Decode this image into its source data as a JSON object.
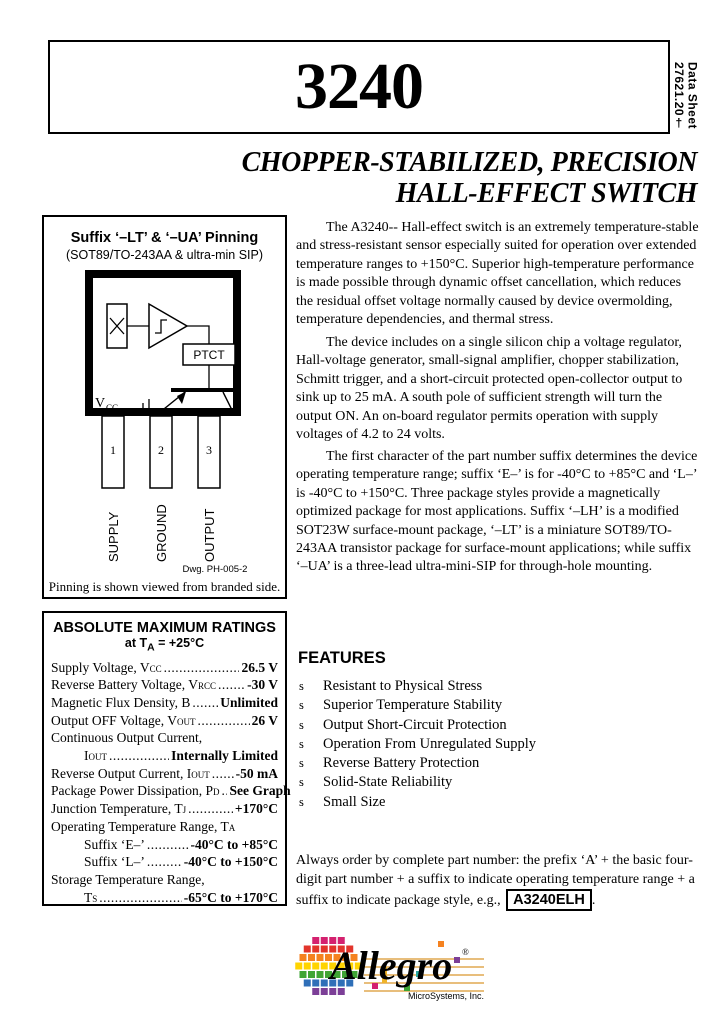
{
  "header": {
    "part_number": "3240",
    "doc_type": "Data Sheet",
    "doc_number": "27621.20†",
    "subtitle_line1": "CHOPPER-STABILIZED, PRECISION",
    "subtitle_line2": "HALL-EFFECT SWITCH"
  },
  "pinning": {
    "title": "Suffix ‘–LT’ & ‘–UA’ Pinning",
    "subtitle": "(SOT89/TO-243AA & ultra-min SIP)",
    "ptct_label": "PTCT",
    "vcc_label": "V",
    "vcc_sub": "CC",
    "pins": [
      {
        "number": "1",
        "label": "SUPPLY"
      },
      {
        "number": "2",
        "label": "GROUND"
      },
      {
        "number": "3",
        "label": "OUTPUT"
      }
    ],
    "drawing_ref": "Dwg. PH-005-2",
    "caption": "Pinning is shown viewed from branded side."
  },
  "description": {
    "p1": "The A3240-- Hall-effect switch is an extremely temperature-stable and stress-resistant sensor especially suited for operation over extended temperature ranges to +150°C.  Superior high-temperature performance is made possible through dynamic offset cancellation, which reduces the residual offset voltage normally caused by device overmolding, temperature dependencies, and thermal stress.",
    "p2": "The device includes on a single silicon chip a voltage regulator, Hall-voltage generator, small-signal amplifier, chopper stabilization, Schmitt trigger, and a short-circuit protected open-collector output to sink up to 25 mA.  A south pole of sufficient strength will turn the output ON.  An on-board regulator permits operation with supply voltages of 4.2 to 24 volts.",
    "p3": "The first character of the part number suffix determines the device operating temperature range; suffix ‘E–’ is for -40°C to +85°C and ‘L–’ is -40°C to +150°C.  Three package styles provide a magnetically optimized package for most applications.  Suffix ‘–LH’ is a modified SOT23W surface-mount package, ‘–LT’ is a miniature SOT89/TO-243AA transistor package for surface-mount applications; while suffix ‘–UA’ is a three-lead ultra-mini-SIP for through-hole mounting."
  },
  "ratings": {
    "title": "ABSOLUTE MAXIMUM RATINGS",
    "subtitle_pre": "at T",
    "subtitle_sub": "A",
    "subtitle_post": " = +25°C",
    "lines": [
      {
        "pre": "Supply Voltage, V",
        "sub": "CC",
        "value": "26.5 V"
      },
      {
        "pre": "Reverse Battery Voltage, V",
        "sub": "RCC",
        "value": "-30 V"
      },
      {
        "pre": "Magnetic Flux Density, B",
        "sub": "",
        "value": "Unlimited"
      },
      {
        "pre": "Output OFF Voltage, V",
        "sub": "OUT",
        "value": "26 V"
      },
      {
        "pre": "Continuous Output Current,",
        "sub": "",
        "value": ""
      },
      {
        "pre": "I",
        "sub": "OUT",
        "value": "Internally Limited"
      },
      {
        "pre": "Reverse Output Current, I",
        "sub": "OUT",
        "value": "-50 mA"
      },
      {
        "pre": "Package Power Dissipation, P",
        "sub": "D",
        "value": "See Graph"
      },
      {
        "pre": "Junction Temperature, T",
        "sub": "J",
        "value": "+170°C"
      },
      {
        "pre": "Operating Temperature Range, T",
        "sub": "A",
        "value": ""
      },
      {
        "pre": "Suffix ‘E–’",
        "sub": "",
        "value": "-40°C to +85°C"
      },
      {
        "pre": "Suffix ‘L–’",
        "sub": "",
        "value": "-40°C to +150°C"
      },
      {
        "pre": "Storage Temperature Range,",
        "sub": "",
        "value": ""
      },
      {
        "pre": "T",
        "sub": "S",
        "value": "-65°C to +170°C"
      }
    ]
  },
  "features": {
    "title": "FEATURES",
    "bullet": "s",
    "items": [
      "Resistant to Physical Stress",
      "Superior Temperature Stability",
      "Output Short-Circuit Protection",
      "Operation From Unregulated Supply",
      "Reverse Battery Protection",
      "Solid-State Reliability",
      "Small Size"
    ]
  },
  "ordering": {
    "pre": "Always order by complete part number: the prefix ‘A’ + the basic four-digit part number + a suffix to indicate operating temperature range + a suffix to indicate package style, e.g., ",
    "part_number": "A3240ELH",
    "post": "."
  },
  "logo": {
    "brand": "Allegro",
    "registered": "®",
    "company": "MicroSystems, Inc.",
    "colors": {
      "row_magenta": "#d4216f",
      "row_red": "#e2342b",
      "row_orange": "#f58220",
      "row_yellow": "#ffd400",
      "row_green": "#3fa535",
      "row_blue": "#2f6fb8",
      "row_purple": "#7c3f97",
      "staff": "#d9982f",
      "teal": "#2aa8a0"
    }
  }
}
